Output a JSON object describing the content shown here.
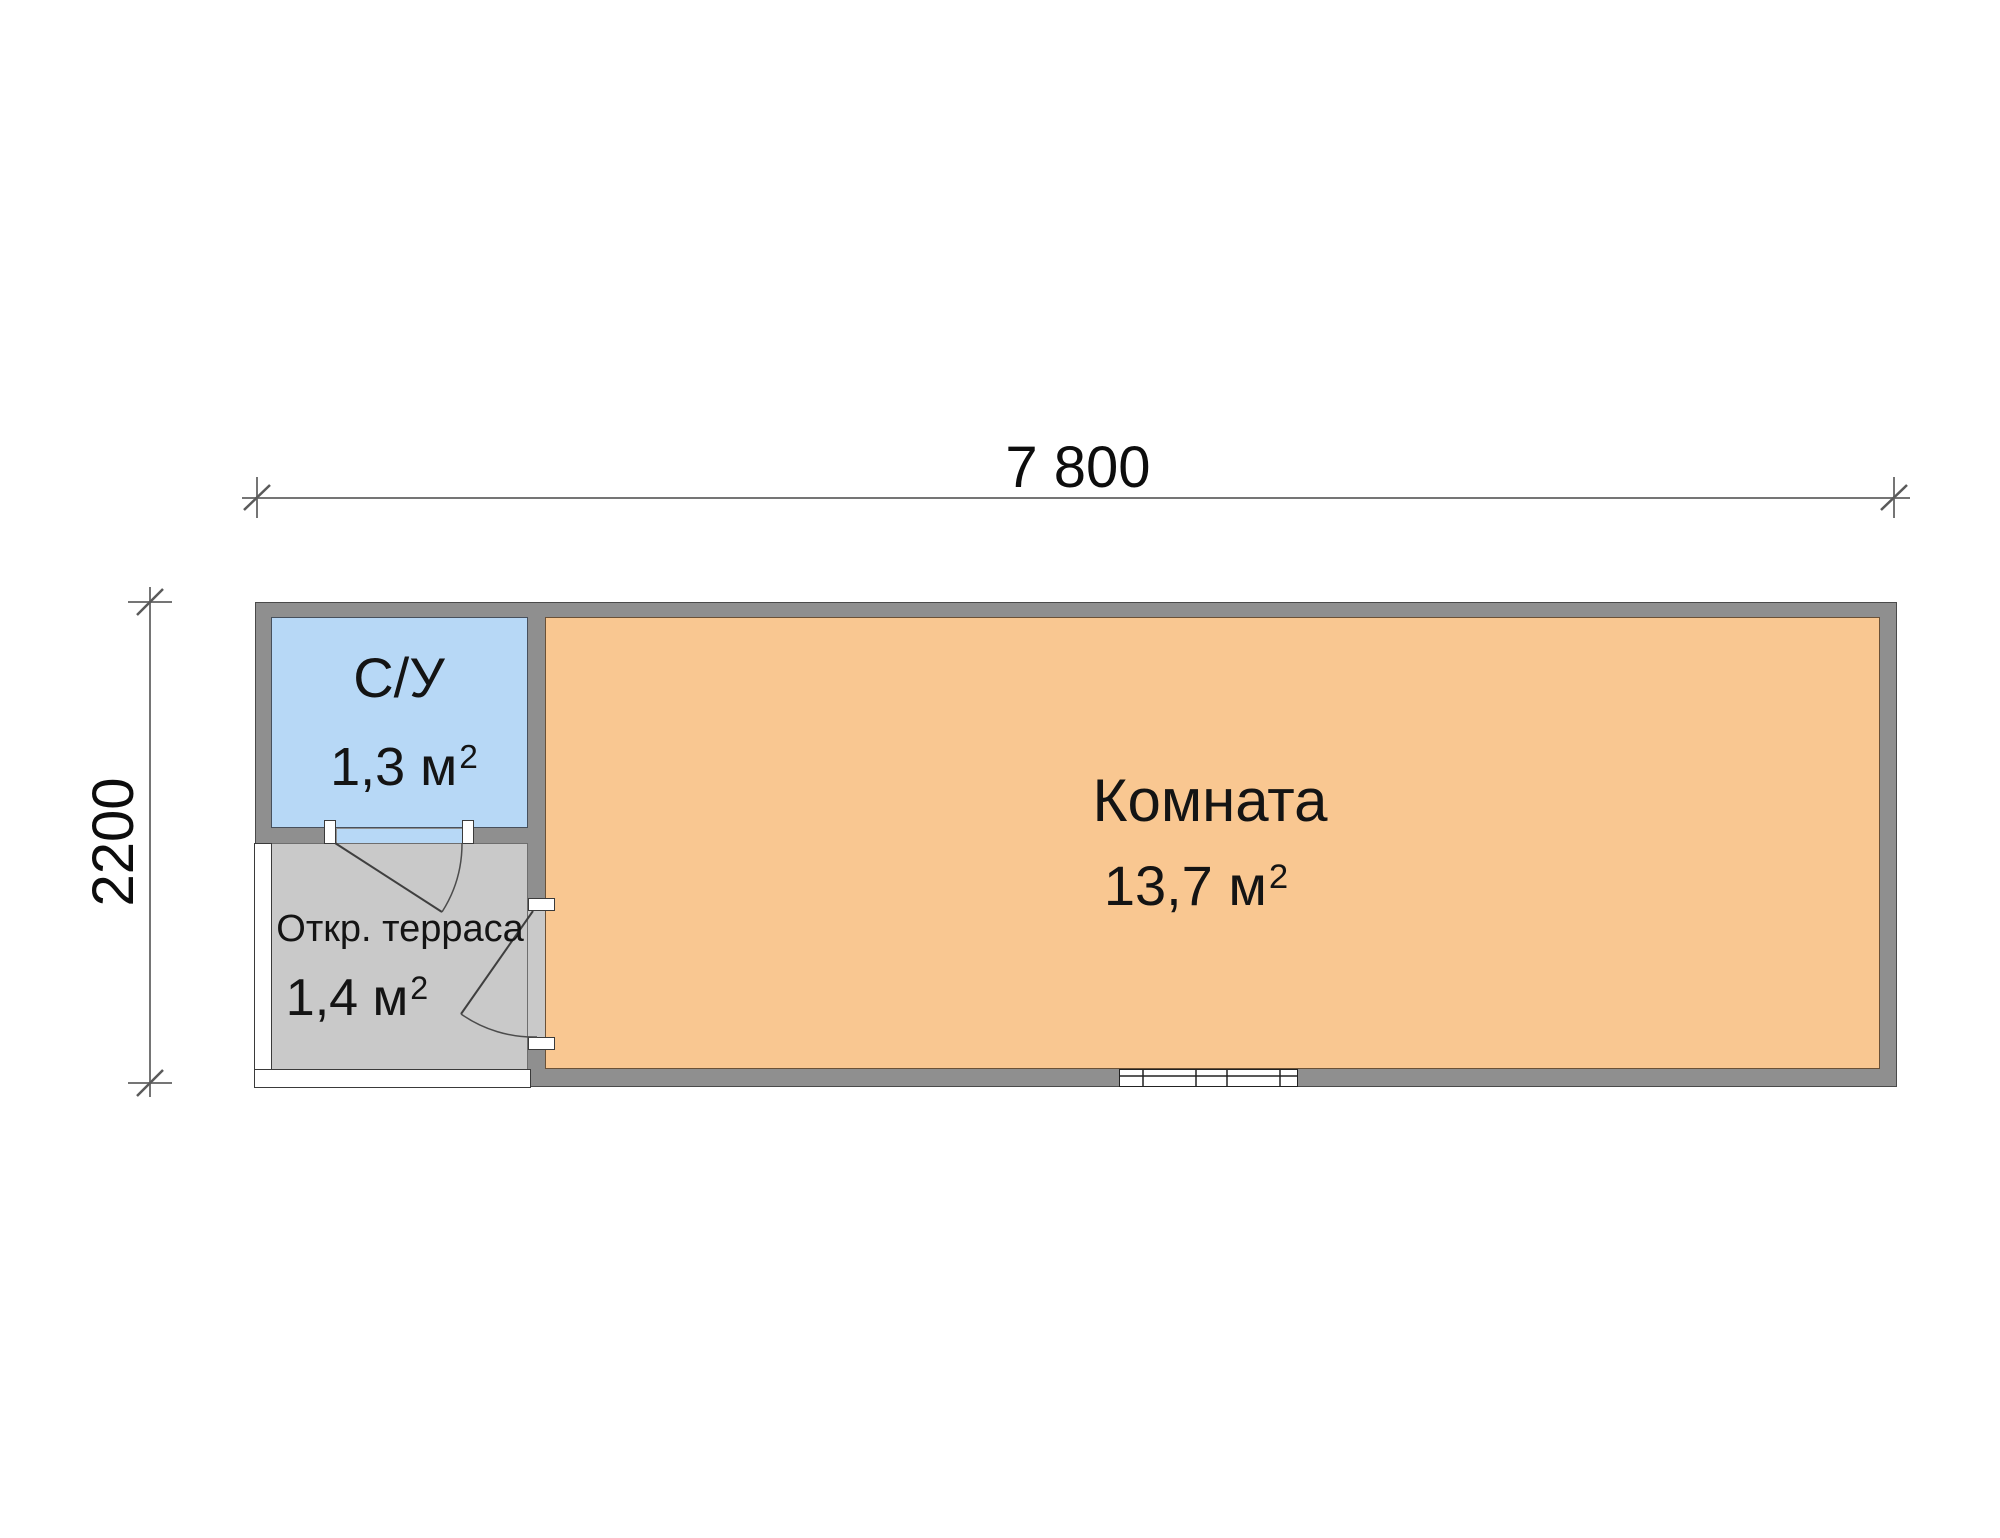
{
  "dimensions": {
    "width_label": "7 800",
    "height_label": "2200"
  },
  "rooms": {
    "bathroom": {
      "name": "С/У",
      "area": "1,3 м",
      "area_exp": "2"
    },
    "terrace": {
      "name": "Откр. терраса",
      "area": "1,4 м",
      "area_exp": "2"
    },
    "room": {
      "name": "Комната",
      "area": "13,7 м",
      "area_exp": "2"
    }
  },
  "colors": {
    "wall": "#8f8f8f",
    "bathroom_fill": "#b7d8f6",
    "terrace_fill": "#c9c9c9",
    "room_fill": "#f9c791",
    "open_edge_fill": "#ffffff",
    "dimension_line": "#757575",
    "text": "#141414"
  }
}
